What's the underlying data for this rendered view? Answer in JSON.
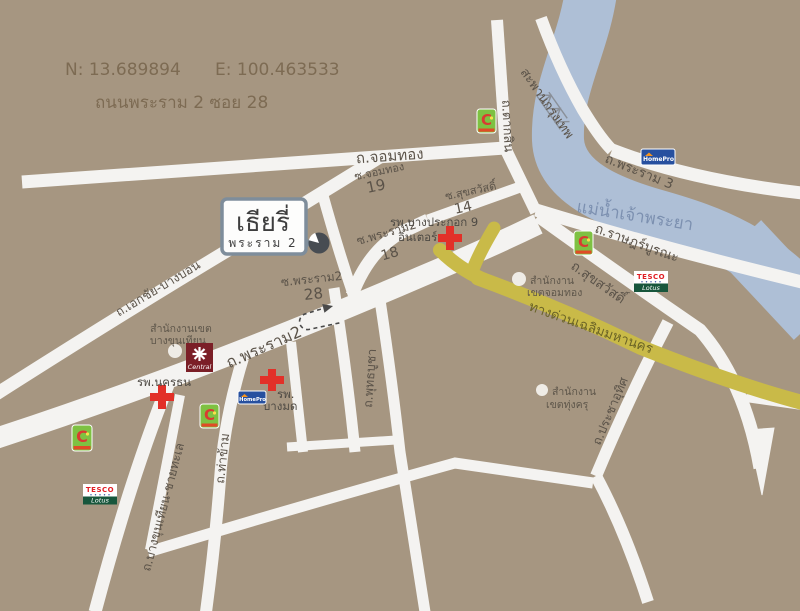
{
  "header": {
    "north": "N: 13.689894",
    "east": "E: 100.463533",
    "address": "ถนนพระราม 2 ซอย 28"
  },
  "project": {
    "name": "เธียรี่",
    "subtitle": "พระราม 2"
  },
  "river": {
    "name": "แม่น้ำเจ้าพระยา"
  },
  "expressway": {
    "name": "ทางด่วนเฉลิมมหานคร"
  },
  "roads": {
    "jomthong": "ถ.จอมทอง",
    "taksin": "ถ.ตากสิน",
    "bridge": "สะพานกรุงเทพ",
    "rama3": "ถ.พระราม 3",
    "ratburana": "ถ.ราษฎร์บูรณะ",
    "suksawat": "ถ.สุขสวัสดิ์",
    "rama2": "ถ.พระราม2",
    "ekachai": "ถ.เอกชัย-บางบอน",
    "bangkhunthian": "ถ.บางขุนเทียน-ชายทะเล",
    "thakham": "ถ.ท่าข้าม",
    "phutthabucha": "ถ.พุทธบูชา",
    "prachauthit": "ถ.ประชาอุทิศ"
  },
  "sois": {
    "jomthong19": {
      "name": "ซ.จอมทอง",
      "number": "19"
    },
    "suksawat14": {
      "name": "ซ.สุขสวัสดิ์",
      "number": "14"
    },
    "rama2_18": {
      "name": "ซ.พระราม2",
      "number": "18"
    },
    "rama2_28": {
      "name": "ซ.พระราม2",
      "number": "28"
    }
  },
  "hospitals": {
    "nakhonthon": {
      "name": "รพ.นครธน"
    },
    "bangmod": {
      "line1": "รพ.",
      "line2": "บางมด"
    },
    "bangpakok": {
      "line1": "รพ.บางประกอก 9",
      "line2": "อินเตอร์"
    }
  },
  "offices": {
    "bangkhunthian": {
      "line1": "สำนักงานเขต",
      "line2": "บางขุนเทียน"
    },
    "chomthong": {
      "line1": "สำนักงาน",
      "line2": "เขตจอมทอง"
    },
    "thungkhru": {
      "line1": "สำนักงาน",
      "line2": "เขตทุ่งครุ"
    }
  },
  "brands": {
    "bigc": {
      "letter": "C"
    },
    "tesco": {
      "top": "TESCO",
      "bottom": "Lotus"
    },
    "homepro": {
      "label": "HomePro"
    },
    "central": {
      "label": "Central"
    }
  },
  "colors": {
    "background": "#a69681",
    "road": "#f4f3f1",
    "river": "#aebfd6",
    "expressway": "#c9ba48",
    "road_label": "#5b5349",
    "heading_text": "#7d6b53",
    "hospital_cross": "#e23028",
    "bigc_green": "#7ec142",
    "bigc_red": "#d93b31",
    "tesco_red": "#e01f26",
    "lotus_green": "#17563c",
    "homepro_blue": "#27509f",
    "central_maroon": "#7b1f27",
    "marker_dot": "#474c52",
    "callout_border": "#7e8d9b"
  }
}
